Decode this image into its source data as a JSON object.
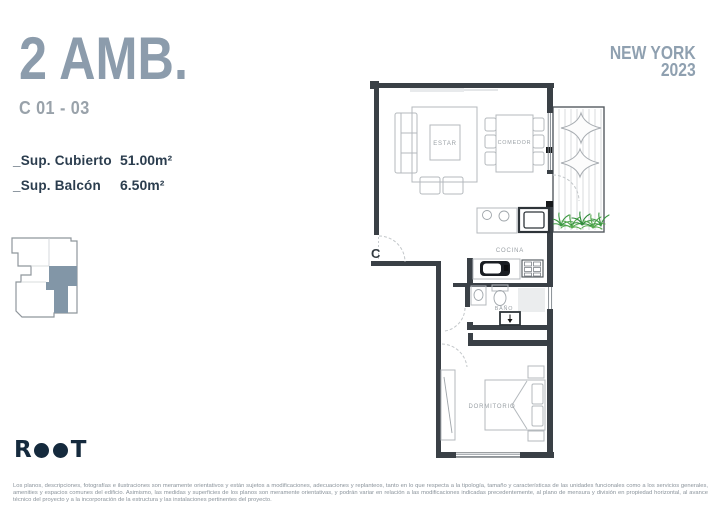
{
  "header": {
    "title": "2 AMB.",
    "unit_range": "C 01 - 03",
    "title_color": "#8C9CAC"
  },
  "brand": {
    "line1": "NEW YORK",
    "line2": "2023",
    "color": "#8FA0B0"
  },
  "surfaces": {
    "rows": [
      {
        "label": "_Sup. Cubierto",
        "value": "51.00m²"
      },
      {
        "label": "_Sup. Balcón",
        "value": "6.50m²"
      }
    ],
    "text_color": "#2B3D4E"
  },
  "keyplan": {
    "highlight_color": "#8296A7"
  },
  "floorplan": {
    "labels": {
      "living": "ESTAR",
      "dining": "COMEDOR",
      "kitchen": "COCINA",
      "bathroom": "BAÑO",
      "bedroom": "DORMITORIO",
      "entrance": "C"
    },
    "wall_color": "#3A4046",
    "furniture_color": "#B4B9BD",
    "plant_green": "#3E9A43"
  },
  "logo": {
    "letters": [
      "R",
      "O",
      "O",
      "T"
    ],
    "color": "#152A3D"
  },
  "disclaimer": {
    "text": "Los planos, descripciones, fotografías e ilustraciones son meramente orientativos y están sujetos a modificaciones, adecuaciones y replanteos, tanto en lo que respecta a la tipología, tamaño y características de las unidades funcionales como a los servicios generales, amenities y espacios comunes del edificio. Asimismo, las medidas y superficies de los planos son meramente orientativas, y podrán variar en relación a las modificaciones indicadas precedentemente, al plano de mensura y división en propiedad horizontal, al avance técnico del proyecto y a la incorporación de la estructura y las instalaciones pertinentes del proyecto."
  }
}
